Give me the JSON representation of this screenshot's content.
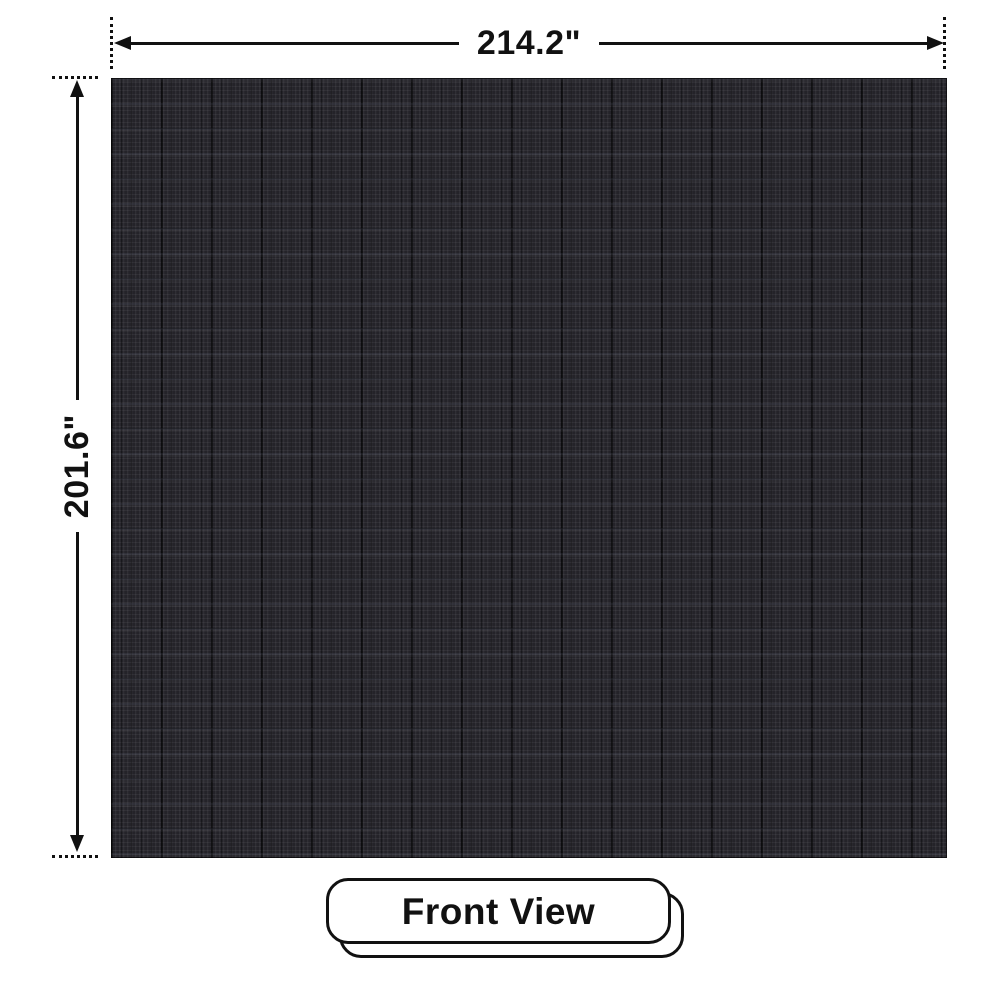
{
  "diagram": {
    "title": "LED display panel front view dimension diagram",
    "view_label": "Front View",
    "dimensions": {
      "width_label": "214.2\"",
      "height_label": "201.6\""
    },
    "panel": {
      "description": "dark LED module grid front face"
    }
  },
  "colors": {
    "ink": "#111111",
    "page-bg": "#ffffff",
    "panel-base": "#242329",
    "badge-bg": "#ffffff"
  }
}
